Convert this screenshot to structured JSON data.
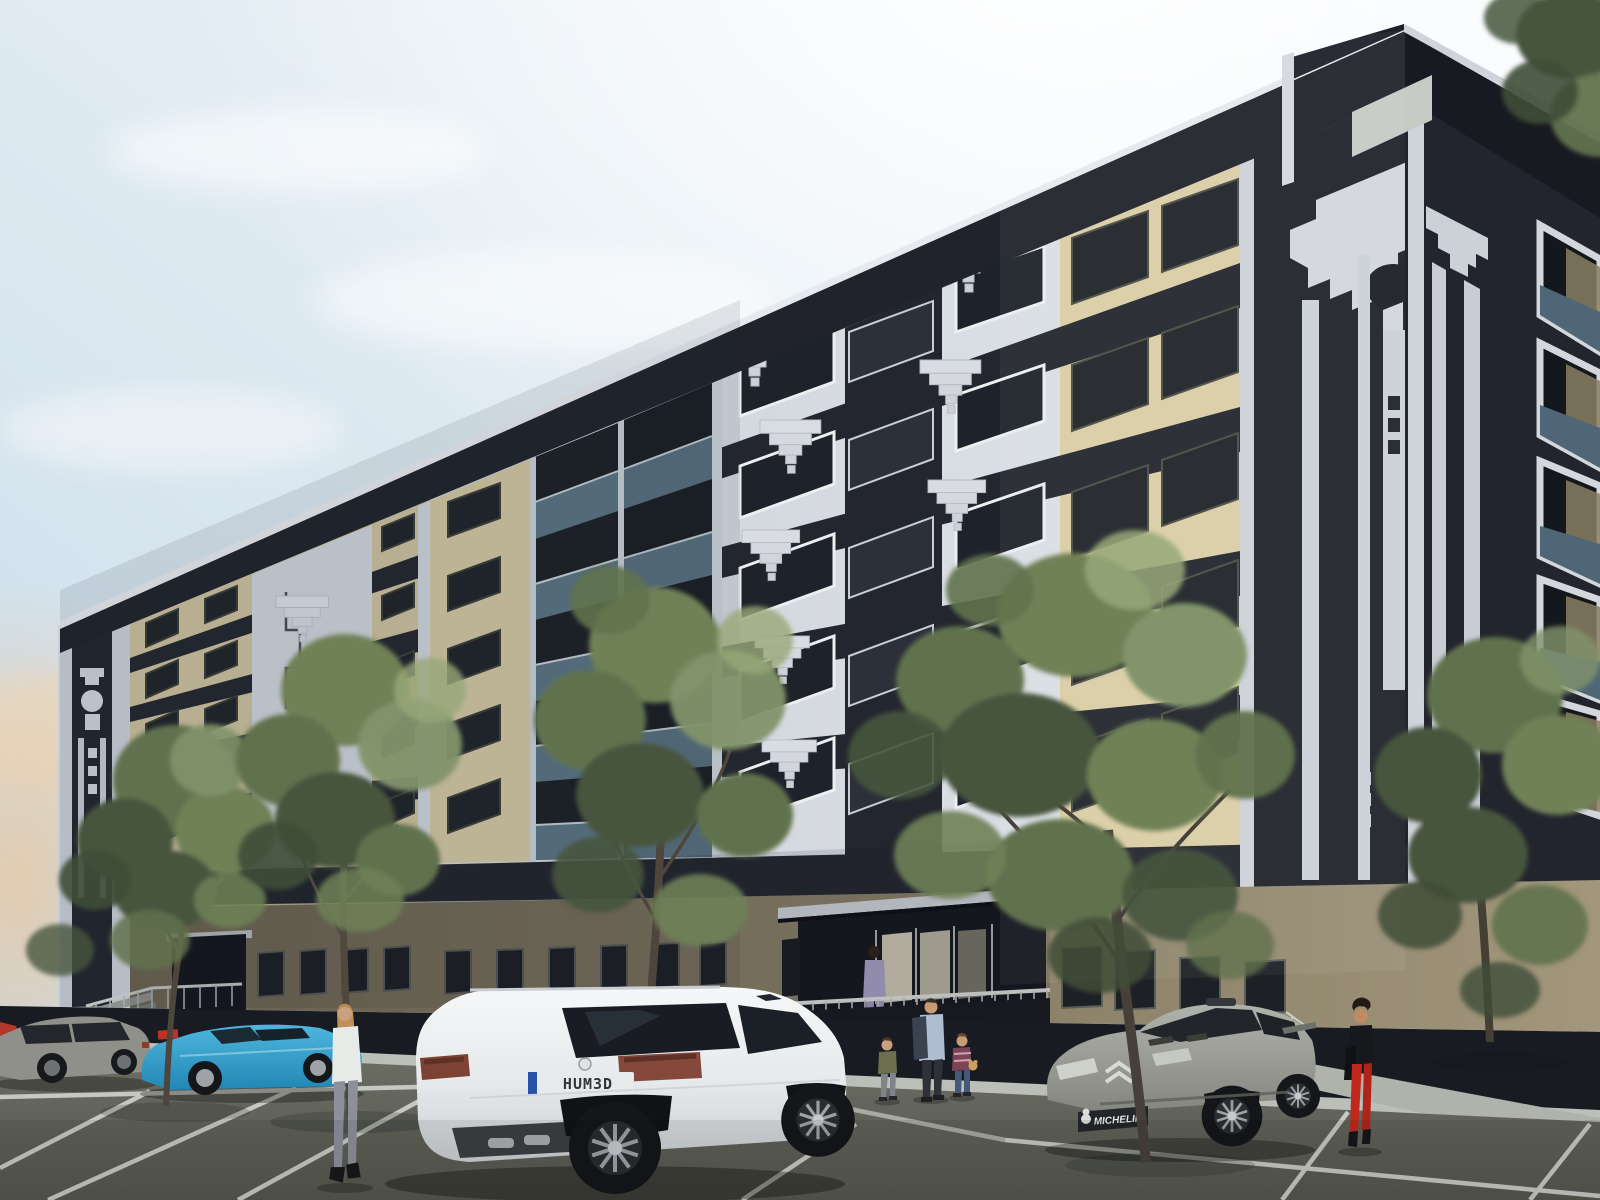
{
  "scene": {
    "title": "Art Deco apartment building exterior 3D render",
    "sky": {
      "zenith": "#eef4f8",
      "horizon_left": "#c9dcea",
      "sun_glow": "#ffffff",
      "warm_glow_left": "#eec28f",
      "clouds": "wispy white, sun glare upper right"
    },
    "building": {
      "style": "art-deco",
      "floors_above_ground": 6,
      "colors": {
        "dark_navy": "#23262e",
        "panel_white": "#d7dbe1",
        "beige": "#d3c6a2",
        "ground_olive": "#7b735c",
        "ground_tan": "#a2967c",
        "glass_teal": "#5e7887"
      },
      "features": [
        "stepped cascade relief ornaments",
        "circle-and-stripe deco crown motif",
        "zigzag meander relief panel",
        "recessed balconies with teal glass balustrades",
        "dark inter-floor spandrel bands",
        "rooftop penthouse volume",
        "underground garage opening",
        "two entrances with metal railings and steps"
      ]
    },
    "vehicles": [
      {
        "name": "white-suv",
        "type": "SUV, rear three-quarter view",
        "color": "#f2f4f5",
        "license_plate": "HUM3D"
      },
      {
        "name": "silver-hatchback",
        "type": "rally hatchback, front three-quarter view",
        "color": "#9a9c96",
        "bumper_text": "MICHELIN"
      },
      {
        "name": "blue-roadster",
        "type": "convertible, side view",
        "color": "#3aa9cf"
      },
      {
        "name": "grey-sedan",
        "type": "sedan, partially visible far left",
        "color": "#8f9089"
      },
      {
        "name": "red-car-edge",
        "type": "car sliver at left image edge",
        "color": "#b5372a"
      }
    ],
    "people": [
      {
        "name": "woman-white-blouse",
        "outfit": "white blouse, grey trousers, black heels"
      },
      {
        "name": "woman-lilac-suit",
        "outfit": "lilac suit, standing on entrance porch"
      },
      {
        "name": "man-blue-shirt",
        "outfit": "blue shirt, dark jacket over shoulder"
      },
      {
        "name": "child-olive-top",
        "outfit": "olive top, grey trousers"
      },
      {
        "name": "child-striped-top",
        "outfit": "striped top, jeans, teddy bear"
      },
      {
        "name": "woman-red-trousers",
        "outfit": "black top, red trousers, black bag"
      }
    ],
    "trees": {
      "count": 6,
      "foliage_colors": [
        "#47553d",
        "#60724d",
        "#6f8156",
        "#81946a",
        "#97a878"
      ]
    },
    "parking": {
      "surface": "#66685f",
      "line_color": "#d4d6d0",
      "marked_stalls": true
    }
  }
}
